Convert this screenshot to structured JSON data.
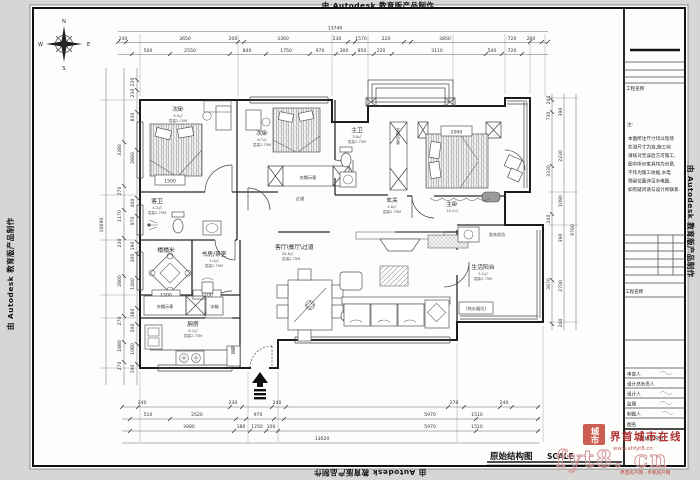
{
  "watermark": {
    "autodesk": "由 Autodesk 教育版产品制作"
  },
  "compass": {
    "n": "N",
    "e": "E",
    "s": "S",
    "w": "W"
  },
  "title": {
    "main": "原始结构图",
    "scale": "SCALE"
  },
  "dims": {
    "top": {
      "total": "13740",
      "row1": [
        "240",
        "3650",
        "200",
        "3360",
        "230",
        "1570",
        "220",
        "3850",
        "720",
        "240"
      ],
      "row2": [
        "500",
        "2550",
        "840",
        "1750",
        "970",
        "300",
        "850",
        "220",
        "3110",
        "540",
        "720"
      ]
    },
    "bottom": {
      "total": "13020",
      "row1": [
        "240",
        "230",
        "240",
        "270",
        "240"
      ],
      "row2": [
        "510",
        "2520",
        "970",
        "5970",
        "1510"
      ],
      "row3": [
        "3080",
        "180",
        "1250",
        "100",
        "5970",
        "1510"
      ]
    },
    "left": {
      "total": "10690",
      "col2": [
        "3280",
        "270",
        "1170",
        "230",
        "2860",
        "270",
        "1880",
        "270"
      ],
      "col3": [
        "230",
        "230",
        "830",
        "2860",
        "400",
        "970",
        "190",
        "300",
        "1460",
        "380",
        "200",
        "1080",
        "190"
      ]
    },
    "right": {
      "total": "9760",
      "col1": [
        "240",
        "730",
        "3330",
        "240",
        "3670"
      ],
      "col2": [
        "390",
        "2230",
        "1090",
        "390",
        "2700",
        "240"
      ]
    },
    "inner": {
      "bed1": "1500",
      "master": "2000",
      "tatami": "1500",
      "study": "1100"
    }
  },
  "rooms": {
    "bedroom1": {
      "label": "次卧",
      "note1": "9.5㎡",
      "note2": "层高2.75M"
    },
    "bedroom2": {
      "label": "次卧",
      "note1": "8.7㎡",
      "note2": "层高2.75M"
    },
    "master": {
      "label": "主卧",
      "note1": "14.2㎡",
      "note2": "层高2.75M"
    },
    "bath_main": {
      "label": "主卫",
      "note1": "3.8㎡",
      "note2": "层高2.75M"
    },
    "bath_guest": {
      "label": "客卫",
      "note1": "4.2㎡",
      "note2": "层高2.75M"
    },
    "tatami": {
      "label": "榻榻米",
      "note1": "6.8㎡"
    },
    "study": {
      "label": "书房/茶室",
      "note1": "5.4㎡",
      "note2": "层高2.75M"
    },
    "kitchen": {
      "label": "厨房",
      "note1": "6.1㎡",
      "note2": "层高2.75M"
    },
    "living": {
      "label": "客厅\\餐厅\\过道",
      "note1": "28.6㎡",
      "note2": "层高2.75M"
    },
    "entry": {
      "label": "玄关",
      "note1": "4.6㎡",
      "note2": "层高2.75M"
    },
    "balcony_service": {
      "label": "生活阳台",
      "note1": "5.2㎡",
      "note2": "层高2.75M"
    },
    "corridor": {
      "label": "过道"
    },
    "wardrobe_top": {
      "label": "衣帽示意"
    },
    "wardrobe_column": {
      "label": "衣柜示意"
    },
    "wardrobe_bottom": {
      "label": "衣帽示意"
    },
    "fridge": {
      "label": "冰箱"
    },
    "flue": {
      "label": "烟道"
    },
    "washer": {
      "label": "洗衣机位"
    },
    "heater": {
      "label": "(热水器位)"
    }
  },
  "titleblock": {
    "project_label": "工程名称",
    "note_title": "注:",
    "notes": [
      "本图所注尺寸均以现场",
      "实测尺寸为准,施工前",
      "请核对无误后方可施工,",
      "图中所示家具均为示意,",
      "不作为施工依据,水电",
      "预留位置详见水电图,",
      "如有疑问请与设计师联系."
    ],
    "record_label": "工程名称",
    "fields": [
      "审定人",
      "设计总负责人",
      "设计人",
      "监理",
      "制图人"
    ],
    "drawing_label": "图名",
    "drawing_name": "原始结构图"
  },
  "stamp": {
    "seal": "城市",
    "site": "界首城市在线",
    "url": "www.ahfyt8.cn",
    "big": "fyt8. cn",
    "footer": "界首房产网 · 手机房产网"
  }
}
